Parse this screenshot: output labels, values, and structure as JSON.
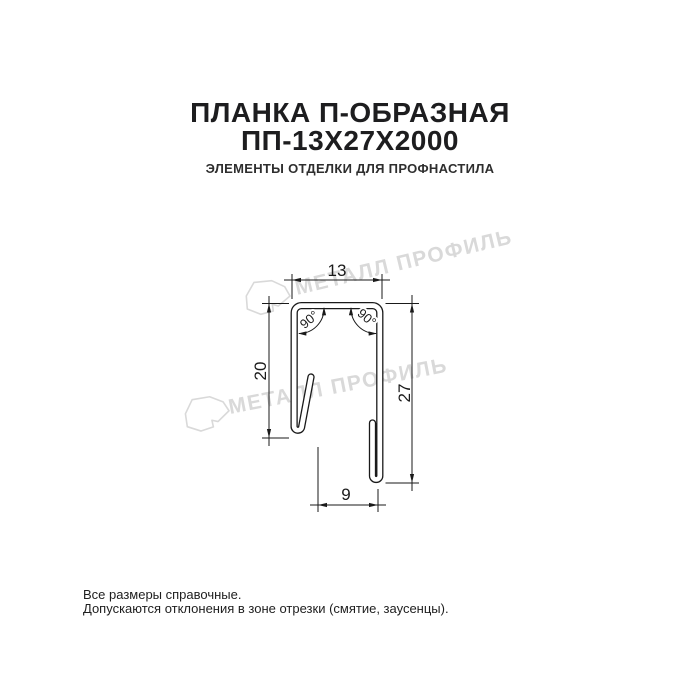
{
  "header": {
    "title_line1": "ПЛАНКА П-ОБРАЗНАЯ",
    "title_line2": "ПП-13Х27Х2000",
    "subtitle": "ЭЛЕМЕНТЫ ОТДЕЛКИ ДЛЯ ПРОФНАСТИЛА"
  },
  "drawing": {
    "watermark_text": "МЕТАЛЛ ПРОФИЛЬ",
    "dimensions": {
      "top_width": "13",
      "left_height": "20",
      "right_height": "27",
      "bottom_width": "9",
      "angle_left": "90°",
      "angle_right": "90°"
    }
  },
  "footer": {
    "line1": "Все размеры справочные.",
    "line2": "Допускаются отклонения в зоне отрезки (смятие, заусенцы)."
  },
  "colors": {
    "title": "#1d1d1f",
    "subtitle": "#2e2e2e",
    "line": "#1a1a1a",
    "watermark": "#d9d9d9",
    "background": "#ffffff"
  }
}
